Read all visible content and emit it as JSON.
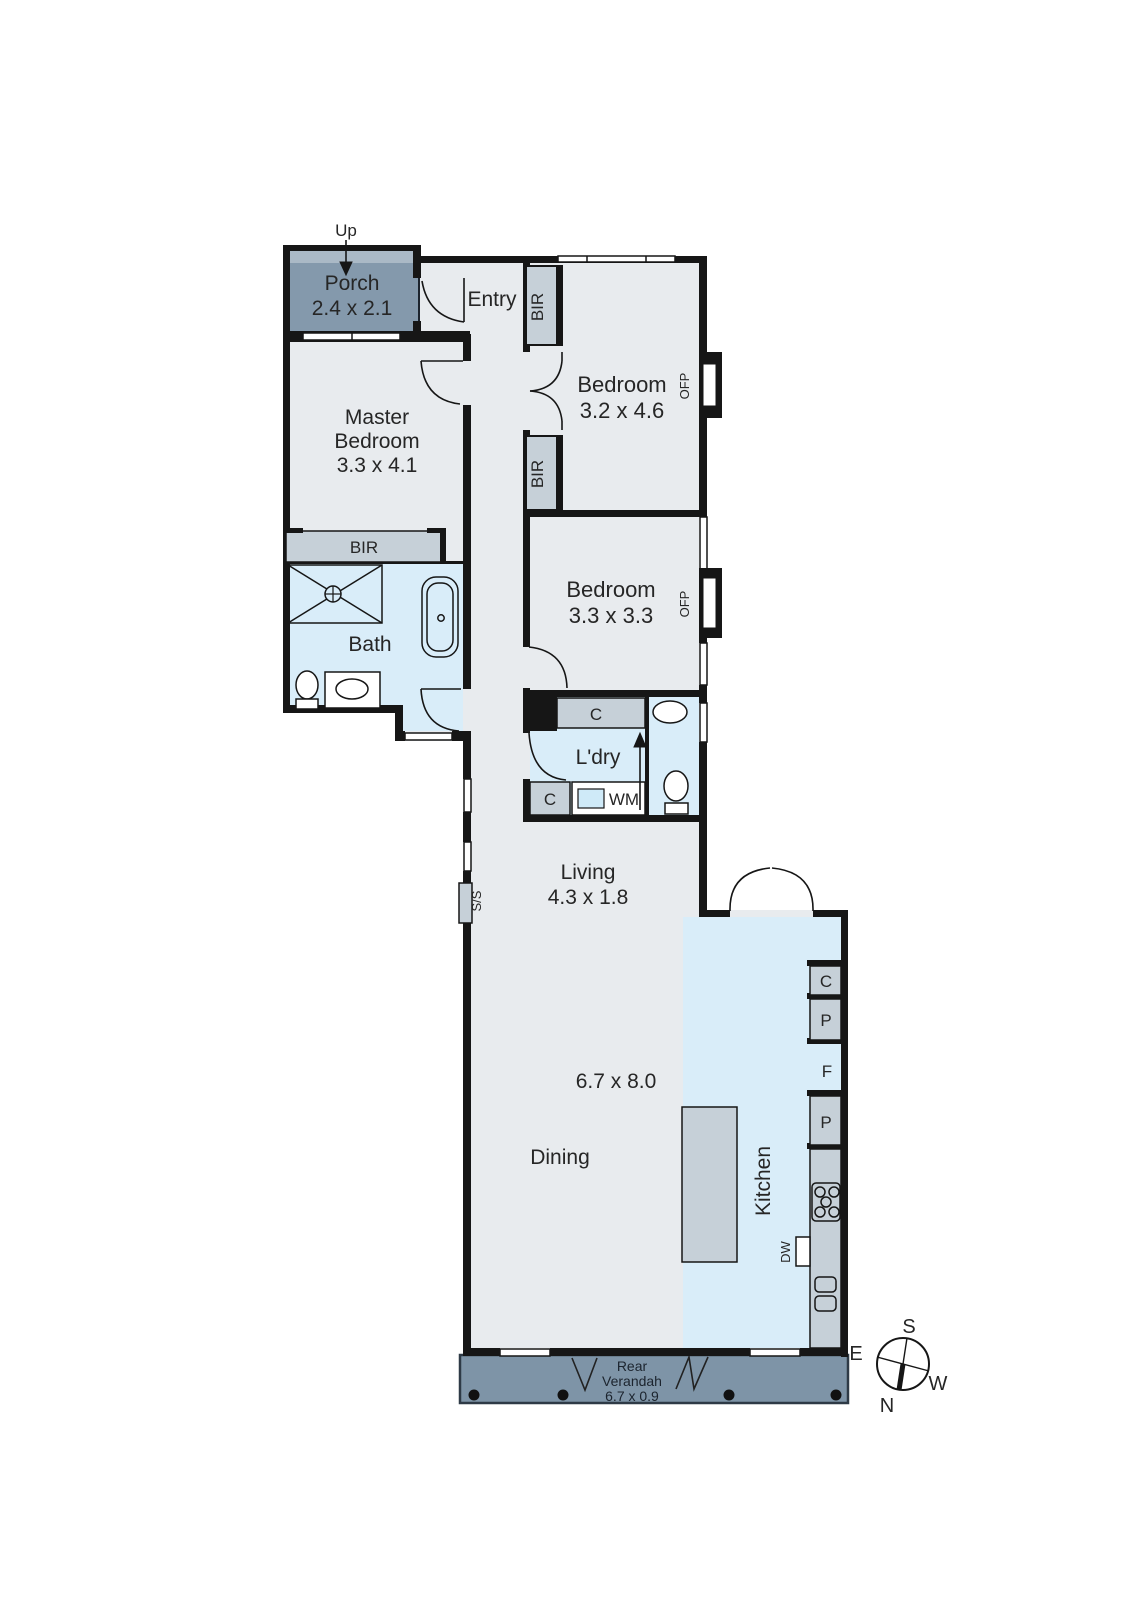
{
  "floorplan": {
    "porch": {
      "label": "Porch",
      "dims": "2.4 x 2.1",
      "up": "Up"
    },
    "entry": {
      "label": "Entry"
    },
    "master_bedroom": {
      "label_line1": "Master",
      "label_line2": "Bedroom",
      "dims": "3.3 x 4.1",
      "wardrobe": "BIR"
    },
    "bedroom_1": {
      "label": "Bedroom",
      "dims": "3.2 x 4.6",
      "wardrobe_top": "BIR",
      "wardrobe_bottom": "BIR",
      "fireplace": "OFP"
    },
    "bedroom_2": {
      "label": "Bedroom",
      "dims": "3.3 x 3.3",
      "fireplace": "OFP"
    },
    "bath": {
      "label": "Bath"
    },
    "laundry": {
      "label": "L'dry",
      "cupboard_top": "C",
      "cupboard_bottom": "C",
      "washing_machine": "WM"
    },
    "living": {
      "label": "Living",
      "dims": "4.3 x 1.8"
    },
    "dining": {
      "label": "Dining"
    },
    "open_plan_dims": "6.7 x 8.0",
    "kitchen": {
      "label": "Kitchen",
      "cupboard": "C",
      "pantry_upper": "P",
      "fridge": "F",
      "pantry_lower": "P",
      "dishwasher": "DW"
    },
    "rear_verandah": {
      "label_line1": "Rear",
      "label_line2": "Verandah",
      "dims": "6.7 x 0.9"
    },
    "side_service": "S/S",
    "compass": {
      "north": "N",
      "south": "S",
      "east": "E",
      "west": "W"
    },
    "colors": {
      "wall": "#161616",
      "floor": "#e8ebee",
      "wet_area": "#d9edf9",
      "joinery": "#c6d0d8",
      "porch_fill": "#8499ac",
      "porch_band": "#aab9c6",
      "verandah_fill": "#7e94a7",
      "text": "#262626"
    }
  }
}
